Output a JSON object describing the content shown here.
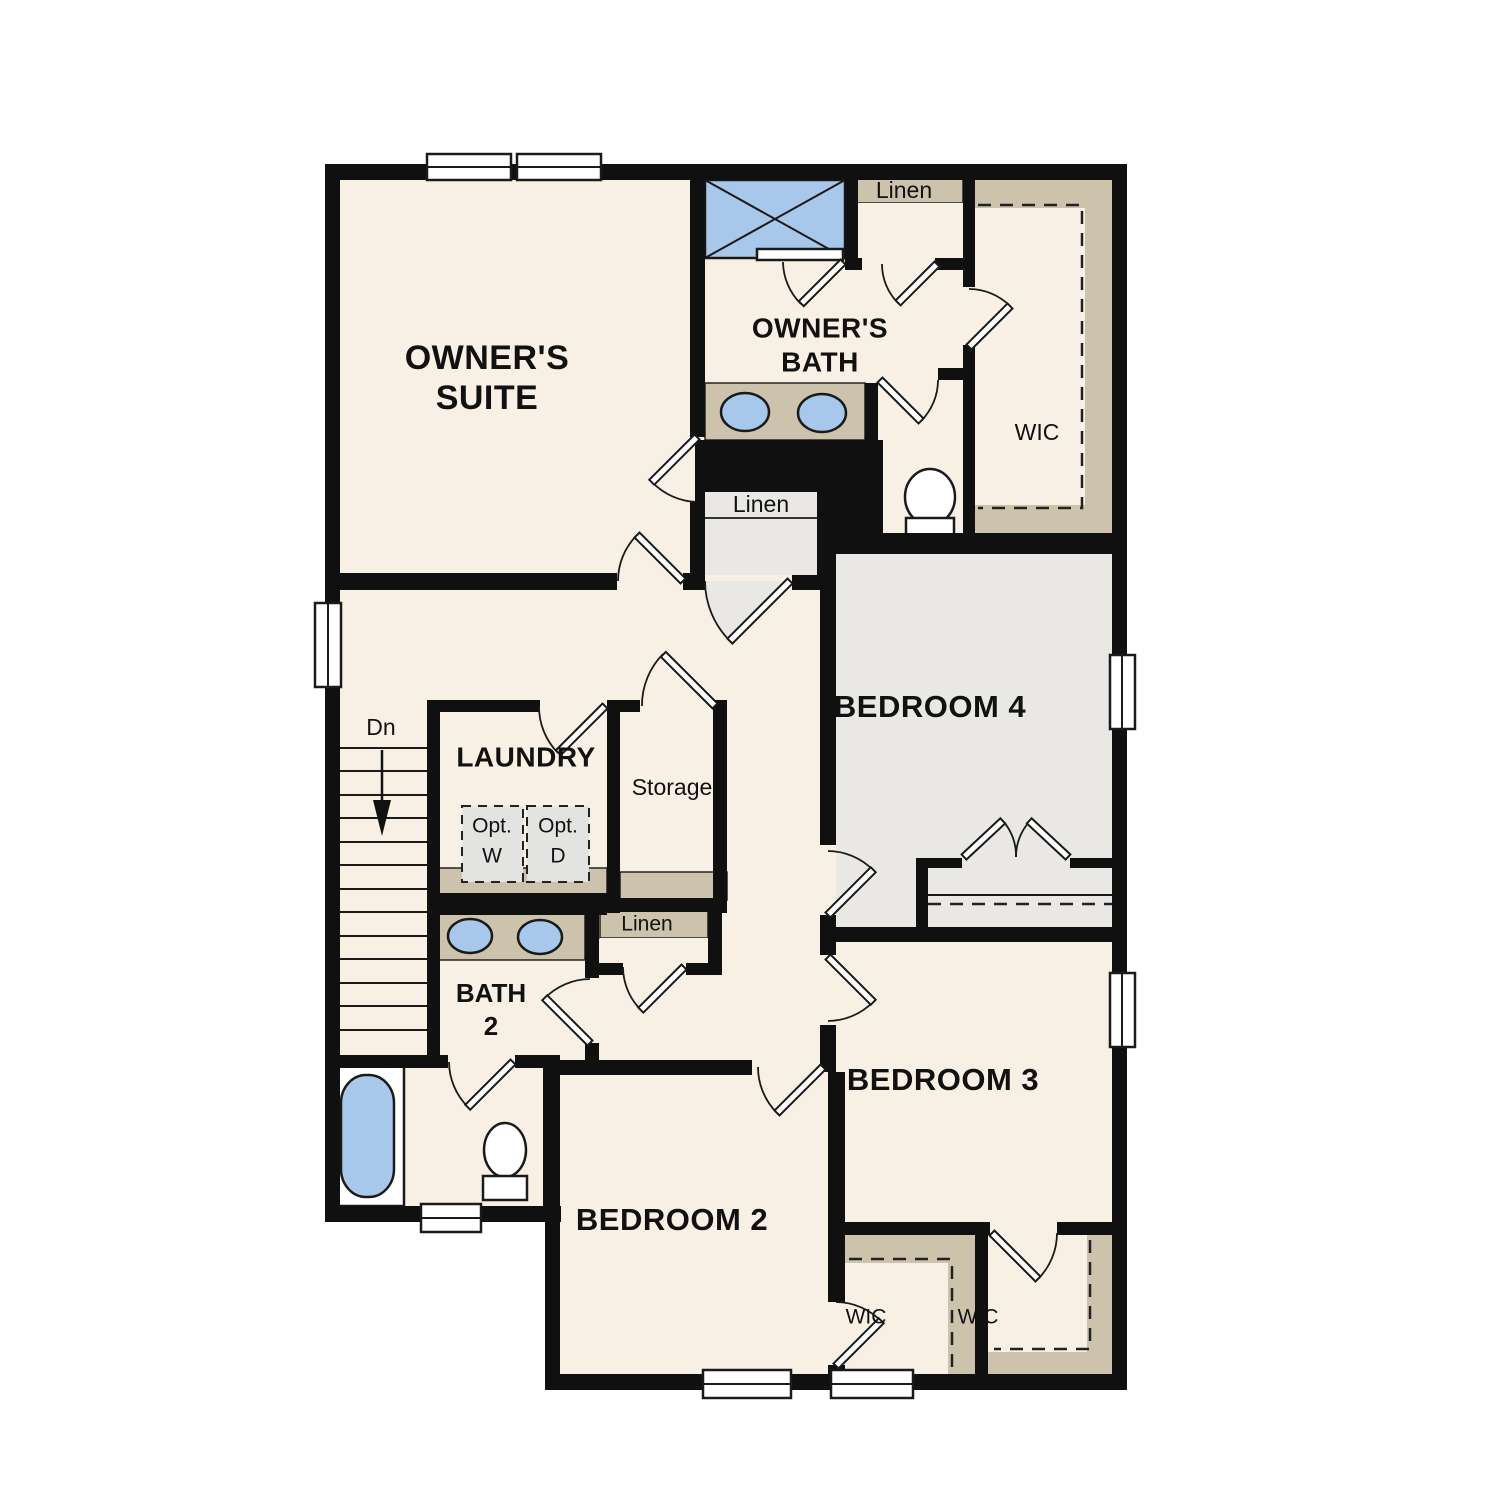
{
  "labels": {
    "owners_suite": [
      "OWNER'S",
      "SUITE"
    ],
    "owners_bath": [
      "OWNER'S",
      "BATH"
    ],
    "wic_owners": "WIC",
    "linen_owners_bath": "Linen",
    "linen_hall": "Linen",
    "linen_bath2": "Linen",
    "bedroom_4": "BEDROOM 4",
    "bedroom_3": "BEDROOM 3",
    "bedroom_2": "BEDROOM 2",
    "laundry": "LAUNDRY",
    "storage": "Storage",
    "bath_2": [
      "BATH",
      "2"
    ],
    "wic_bedroom2": "WIC",
    "wic_bedroom3": "WIC",
    "stairs_direction": "Dn",
    "opt_washer": [
      "Opt.",
      "W"
    ],
    "opt_dryer": [
      "Opt.",
      "D"
    ]
  },
  "colors": {
    "wall": "#101010",
    "room": "#f8f0e4",
    "grayroom": "#e9e8e5",
    "shelf": "#cdc2ac",
    "fixture": "#a7c8ea",
    "optgray": "#e3e3e1",
    "background": "#ffffff"
  }
}
